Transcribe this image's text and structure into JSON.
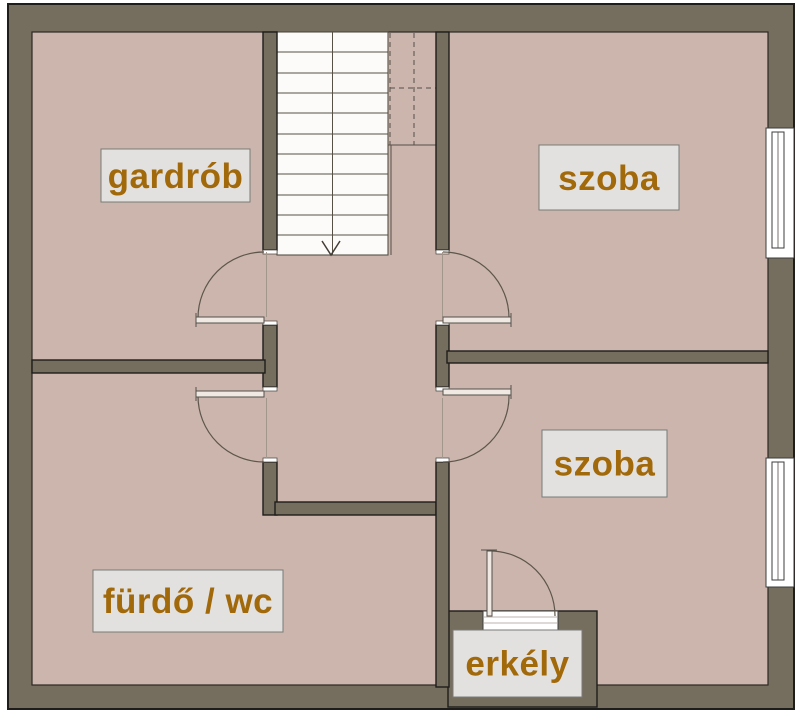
{
  "floorplan": {
    "rooms": [
      {
        "label": "gardrób"
      },
      {
        "label": "szoba"
      },
      {
        "label": "szoba"
      },
      {
        "label": "fürdő / wc"
      },
      {
        "label": "erkély"
      }
    ],
    "features": {
      "staircase": "stairs with down arrow",
      "windows": 2,
      "doors": 5
    },
    "colors": {
      "wall": "#756e5f",
      "floor": "#cbb5ad",
      "stairs": "#fcfbfa",
      "label_bg": "#e3e1df",
      "label_text": "#a2690b",
      "outline": "#1f1d1a",
      "line": "#565046"
    }
  }
}
